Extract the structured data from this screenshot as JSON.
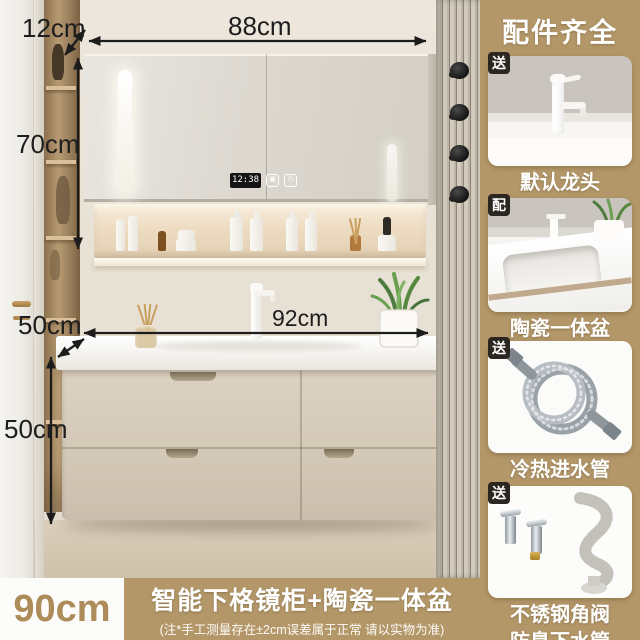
{
  "annotations": {
    "mirror_depth": "12cm",
    "mirror_width": "88cm",
    "mirror_height": "70cm",
    "counter_depth": "50cm",
    "counter_width": "92cm",
    "cabinet_height": "50cm",
    "clock_time": "12:38"
  },
  "icons": {
    "defog_glyph": "▣",
    "light_glyph": "◷"
  },
  "sidebar": {
    "title": "配件齐全",
    "items": [
      {
        "badge": "送",
        "label": "默认龙头"
      },
      {
        "badge": "配",
        "label": "陶瓷一体盆"
      },
      {
        "badge": "送",
        "label": "冷热进水管"
      },
      {
        "badge": "送",
        "label": "不锈钢角阀",
        "label2": "防臭下水管"
      }
    ]
  },
  "bottom_bar": {
    "size_label": "90cm",
    "title": "智能下格镜柜+陶瓷一体盆",
    "note": "(注*手工测量存在±2cm误差属于正常 请以实物为准)"
  },
  "colors": {
    "accent_tan": "#b39769",
    "badge_dark": "#2c2620",
    "dimension_text": "#1d1d1d"
  }
}
